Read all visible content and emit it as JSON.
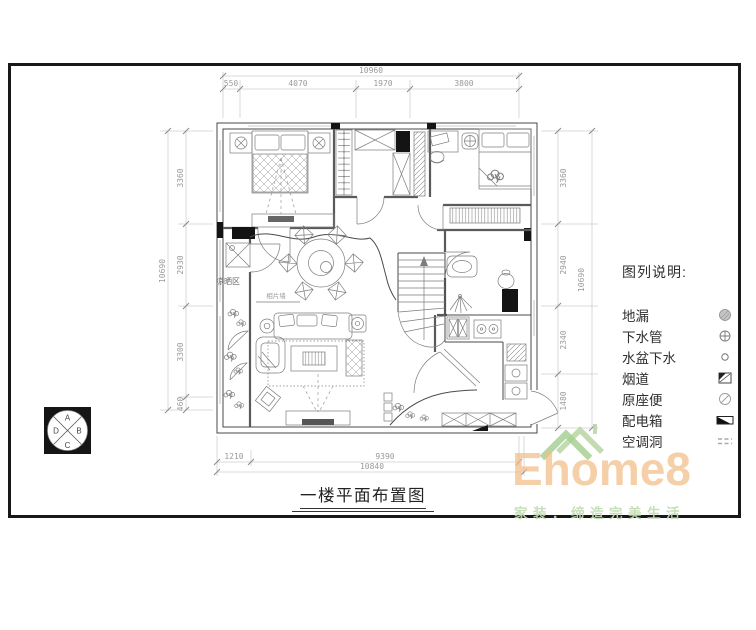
{
  "drawing": {
    "title": "一楼平面布置图",
    "dimensions": {
      "top": {
        "overall": "10960",
        "segments": [
          "550",
          "4070",
          "1970",
          "3800"
        ]
      },
      "left": {
        "overall": "10690",
        "segments": [
          "3360",
          "2930",
          "3300",
          "460"
        ]
      },
      "right": {
        "overall": "10690",
        "segments": [
          "3360",
          "2940",
          "2340",
          "1480"
        ]
      },
      "bottom": {
        "segment_left": "1210",
        "inner": "9390",
        "overall": "10840"
      }
    },
    "room_labels": {
      "drying_area": "凉晒区",
      "photo_wall": "相片墙"
    }
  },
  "legend": {
    "title": "图列说明:",
    "items": [
      {
        "label": "地漏",
        "symbol": "floor-drain"
      },
      {
        "label": "下水管",
        "symbol": "drain-pipe"
      },
      {
        "label": "水盆下水",
        "symbol": "sink-drain"
      },
      {
        "label": "烟道",
        "symbol": "flue"
      },
      {
        "label": "原座便",
        "symbol": "original-toilet"
      },
      {
        "label": "配电箱",
        "symbol": "distribution-box"
      },
      {
        "label": "空调洞",
        "symbol": "ac-hole"
      }
    ]
  },
  "stamp": {
    "letters": [
      "A",
      "B",
      "C",
      "D"
    ]
  },
  "logo": {
    "name": "Ehome8",
    "tagline": "家装．缔造完美生活"
  },
  "colors": {
    "line": "#4a4a4a",
    "dim_text": "#9a9a9a",
    "frame": "#181818",
    "logo_orange": "#f2bd86",
    "logo_green": "#a8d094",
    "tagline_green": "#c2dbb1"
  }
}
